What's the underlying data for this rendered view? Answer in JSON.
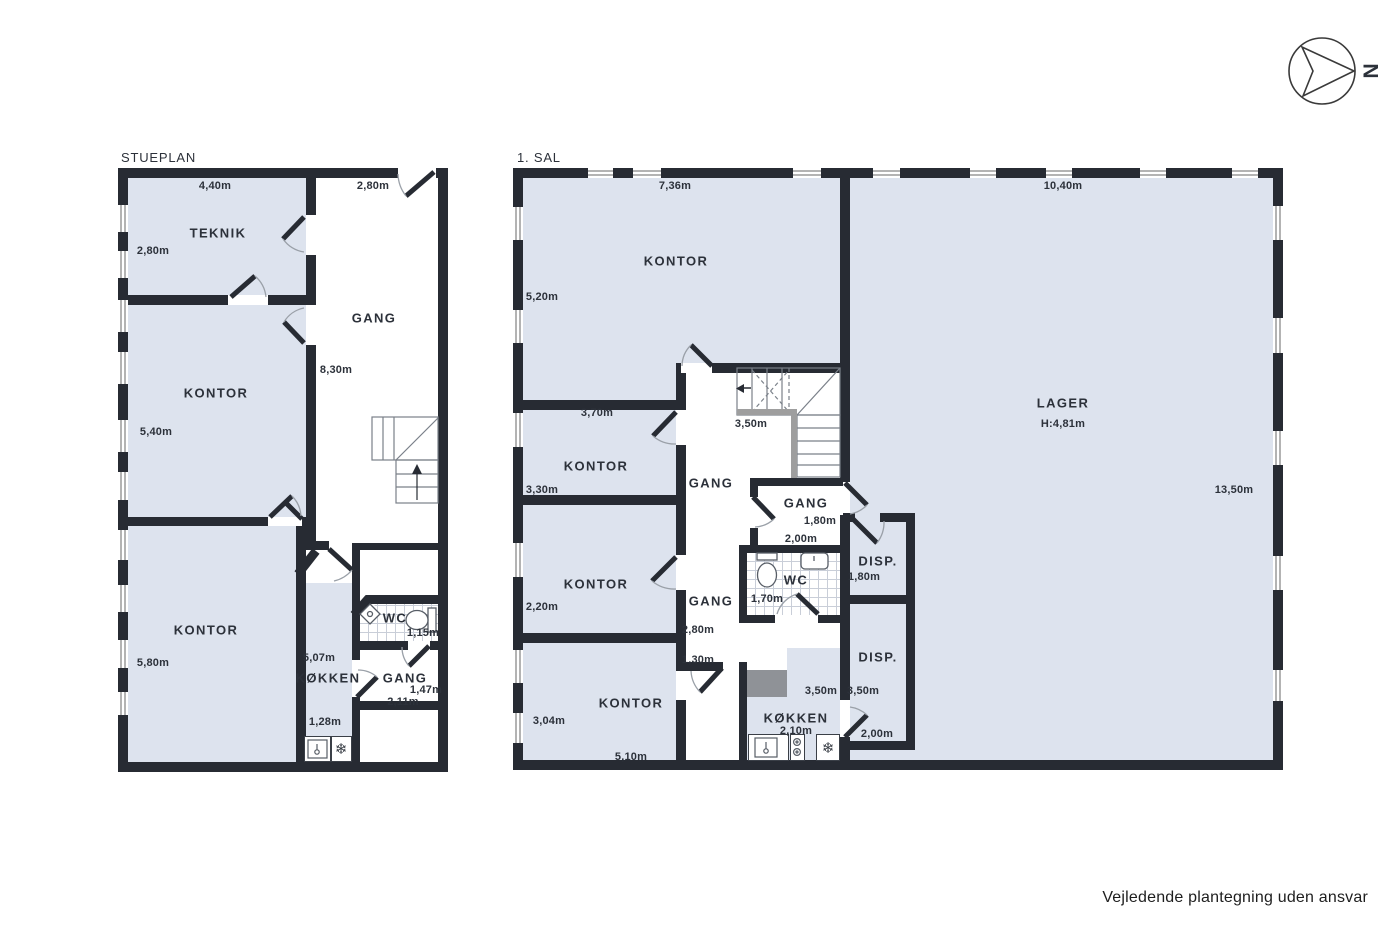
{
  "meta": {
    "footer": "Vejledende plantegning uden ansvar"
  },
  "compass": {
    "label": "N"
  },
  "icons": {
    "fridge_snowflake": "❄"
  },
  "colors": {
    "room_fill": "#dde3ee",
    "wall": "#272b33"
  },
  "stueplan": {
    "title": "STUEPLAN",
    "teknik": {
      "name": "TEKNIK",
      "width": "4,40m",
      "height": "2,80m"
    },
    "gang": {
      "name": "GANG",
      "width": "2,80m",
      "length": "8,30m"
    },
    "kontor_mid": {
      "name": "KONTOR",
      "height": "5,40m"
    },
    "kontor_bottom": {
      "name": "KONTOR",
      "height": "5,80m"
    },
    "kokken": {
      "name": "KØKKEN",
      "length": "5,07m",
      "width": "1,28m"
    },
    "wc": {
      "name": "WC",
      "width": "1,15m"
    },
    "gang_small": {
      "name": "GANG",
      "width": "1,47m",
      "length": "2,11m"
    }
  },
  "sal1": {
    "title": "1. SAL",
    "kontor_top": {
      "name": "KONTOR",
      "width": "7,36m",
      "height": "5,20m"
    },
    "lager": {
      "name": "LAGER",
      "ceiling_height": "H:4,81m",
      "width": "10,40m",
      "height": "13,50m"
    },
    "kontor_2": {
      "name": "KONTOR",
      "width": "3,70m",
      "height": "3,30m"
    },
    "stair_width": "3,50m",
    "gang_center": {
      "name": "GANG"
    },
    "gang_small": {
      "name": "GANG",
      "width": "1,80m",
      "depth": "2,00m"
    },
    "disp_upper": {
      "name": "DISP.",
      "height": "1,80m"
    },
    "wc": {
      "name": "WC",
      "width": "1,70m"
    },
    "kontor_3": {
      "name": "KONTOR",
      "height": "2,20m"
    },
    "gang_lower": {
      "name": "GANG",
      "length": "2,80m",
      "width": "1,30m"
    },
    "disp_lower": {
      "name": "DISP.",
      "height_left": "3,50m",
      "height_right": "3,50m",
      "width": "2,00m"
    },
    "kontor_4": {
      "name": "KONTOR",
      "height": "3,04m",
      "width": "5,10m"
    },
    "kokken": {
      "name": "KØKKEN",
      "width": "2,10m"
    }
  }
}
